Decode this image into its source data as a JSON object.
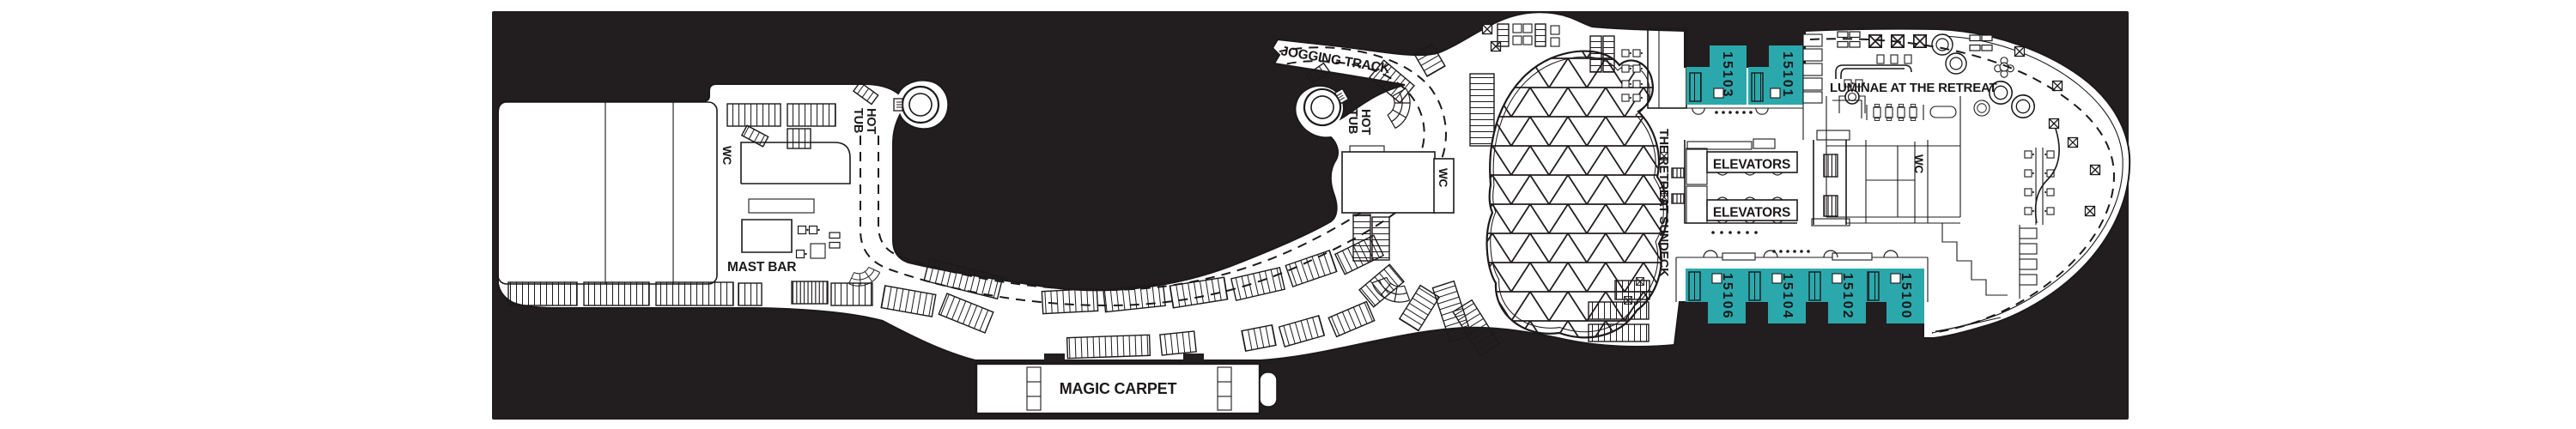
{
  "colors": {
    "accent": "#2BA8AC",
    "plan_bg": "#221E1F",
    "ink": "#1C191A",
    "paper": "#FFFFFF"
  },
  "labels": {
    "jogging_track": "JOGGING TRACK",
    "hot_tub": {
      "line1": "HOT",
      "line2": "TUB"
    },
    "wc": "WC",
    "mast_bar": "MAST BAR",
    "magic_carpet": "MAGIC CARPET",
    "retreat_sundeck": "THE RETREAT SUNDECK",
    "elevators": "ELEVATORS",
    "luminae": "LUMINAE AT THE RETREAT"
  },
  "cabins": [
    {
      "number": "15103"
    },
    {
      "number": "15101"
    },
    {
      "number": "15106"
    },
    {
      "number": "15104"
    },
    {
      "number": "15102"
    },
    {
      "number": "15100"
    }
  ]
}
